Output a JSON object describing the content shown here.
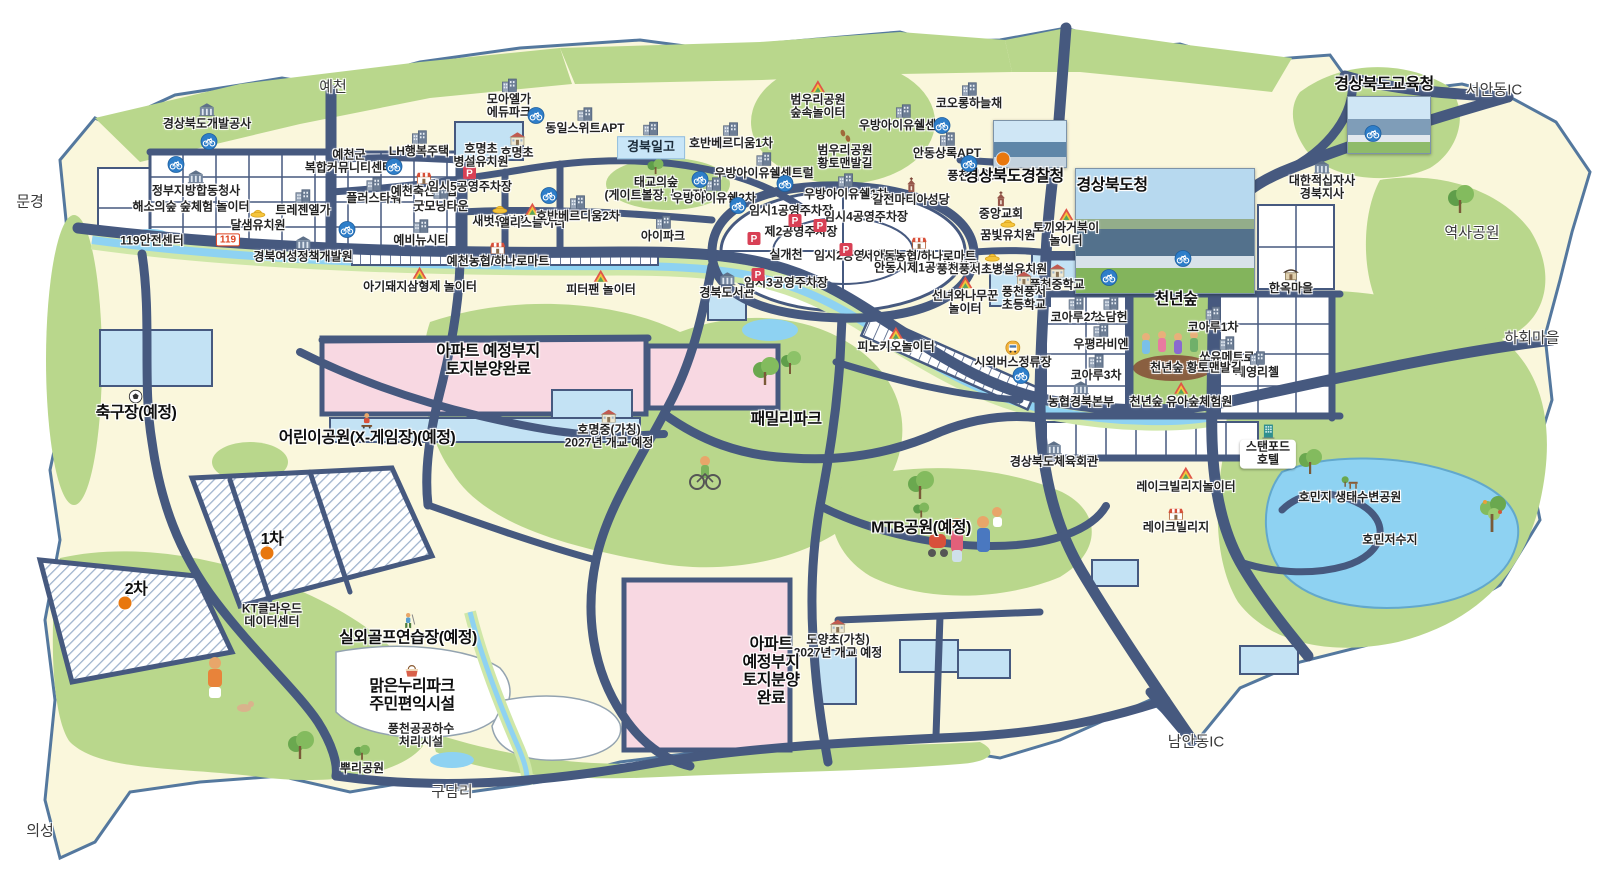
{
  "map": {
    "colors": {
      "road": "#46597f",
      "land": "#faf7dc",
      "park": "#b9d78c",
      "water": "#8ed2f2",
      "river_bank": "#cfe7a8",
      "plot_pink": "#f8d8e2",
      "plot_blue": "#c3e2f4",
      "white_block": "#ffffff",
      "hatch_line": "#9fb3cd",
      "marker_orange": "#e8770e",
      "bike_badge": "#2e7ec9",
      "parking_badge": "#d84055"
    },
    "photos": [
      {
        "name": "gyeongsangbukdo-police-agency-photo",
        "label": "경상북도경찰청"
      },
      {
        "name": "gyeongsangbukdo-provincial-office-photo",
        "label": "경상북도청"
      },
      {
        "name": "gyeongsangbukdo-office-of-education-photo",
        "label": "경상북도교육청"
      }
    ],
    "labels": [
      {
        "t": "예천",
        "x": 333,
        "y": 88,
        "k": "region"
      },
      {
        "t": "문경",
        "x": 30,
        "y": 203,
        "k": "region"
      },
      {
        "t": "의성",
        "x": 40,
        "y": 832,
        "k": "region"
      },
      {
        "t": "구담리",
        "x": 452,
        "y": 793,
        "k": "region"
      },
      {
        "t": "서안동IC",
        "x": 1494,
        "y": 91,
        "k": "region"
      },
      {
        "t": "하회마을",
        "x": 1532,
        "y": 339,
        "k": "region"
      },
      {
        "t": "남안동IC",
        "x": 1196,
        "y": 743,
        "k": "region"
      },
      {
        "t": "역사공원",
        "x": 1472,
        "y": 234,
        "k": "region"
      },
      {
        "t": "경상북도개발공사",
        "x": 207,
        "y": 117,
        "i": "gov"
      },
      {
        "t": "정부지방합동청사",
        "x": 196,
        "y": 184,
        "i": "gov"
      },
      {
        "t": "해소의숲 숲체험 놀이터",
        "x": 191,
        "y": 207
      },
      {
        "t": "119안전센터",
        "x": 152,
        "y": 241
      },
      {
        "t": "119",
        "x": 228,
        "y": 240,
        "k": "b119"
      },
      {
        "t": "달샘유치원",
        "x": 258,
        "y": 220,
        "i": "hat"
      },
      {
        "t": "트레젠엘가",
        "x": 303,
        "y": 203,
        "i": "building"
      },
      {
        "t": "경북여성정책개발원",
        "x": 303,
        "y": 250,
        "i": "gov"
      },
      {
        "t": "예천군\n복합커뮤니티센터",
        "x": 349,
        "y": 162
      },
      {
        "t": "LH행복주택",
        "x": 419,
        "y": 144,
        "i": "building"
      },
      {
        "t": "플러스타워",
        "x": 374,
        "y": 191,
        "i": "building"
      },
      {
        "t": "예천축산농협",
        "x": 424,
        "y": 185,
        "i": "shop"
      },
      {
        "t": "굿모닝타운",
        "x": 441,
        "y": 199,
        "i": "building"
      },
      {
        "t": "임시5공영주차장",
        "x": 470,
        "y": 180,
        "i": "parking"
      },
      {
        "t": "예비뉴시티",
        "x": 421,
        "y": 233,
        "i": "building"
      },
      {
        "t": "모아엘가\n에듀파크",
        "x": 509,
        "y": 99,
        "i": "building"
      },
      {
        "t": "호명초",
        "x": 517,
        "y": 146,
        "i": "school"
      },
      {
        "t": "호명초\n병설유치원",
        "x": 481,
        "y": 156
      },
      {
        "t": "새벗유치원",
        "x": 500,
        "y": 216,
        "i": "hat"
      },
      {
        "t": "앨리스놀이터",
        "x": 532,
        "y": 216,
        "i": "play"
      },
      {
        "t": "동일스위트APT",
        "x": 585,
        "y": 121,
        "i": "building"
      },
      {
        "t": "경북일고",
        "x": 651,
        "y": 140,
        "k": "bluebox",
        "i": "building"
      },
      {
        "t": "태교의숲\n(게이트볼장, 농구장)",
        "x": 656,
        "y": 181,
        "i": "tree"
      },
      {
        "t": "호반베르디움2차",
        "x": 578,
        "y": 209,
        "i": "building"
      },
      {
        "t": "아이파크",
        "x": 663,
        "y": 229,
        "i": "building"
      },
      {
        "t": "예천농협/하나로마트",
        "x": 498,
        "y": 255,
        "i": "shop"
      },
      {
        "t": "아기돼지삼형제 놀이터",
        "x": 420,
        "y": 280,
        "i": "play"
      },
      {
        "t": "피터팬 놀이터",
        "x": 601,
        "y": 283,
        "i": "play"
      },
      {
        "t": "호반베르디움1차",
        "x": 731,
        "y": 136,
        "i": "building"
      },
      {
        "t": "범우리공원\n숲속놀이터",
        "x": 818,
        "y": 100,
        "i": "play"
      },
      {
        "t": "우방아이유쉘센텀",
        "x": 903,
        "y": 118,
        "i": "building"
      },
      {
        "t": "코오롱하늘채",
        "x": 969,
        "y": 96,
        "i": "building"
      },
      {
        "t": "범우리공원\n황토맨발길",
        "x": 845,
        "y": 150,
        "i": "foot"
      },
      {
        "t": "우방아이유쉘센트럴",
        "x": 764,
        "y": 166,
        "i": "building"
      },
      {
        "t": "우방아이유쉘1차",
        "x": 846,
        "y": 187,
        "i": "building"
      },
      {
        "t": "우방아이유쉘2차",
        "x": 714,
        "y": 191,
        "i": "building"
      },
      {
        "t": "안동상록APT",
        "x": 947,
        "y": 146,
        "i": "building"
      },
      {
        "t": "풍천파출소",
        "x": 975,
        "y": 176
      },
      {
        "t": "경상북도경찰청",
        "x": 1014,
        "y": 177,
        "k": "major"
      },
      {
        "t": "갈전마티아성당",
        "x": 911,
        "y": 192,
        "i": "church"
      },
      {
        "t": "중앙교회",
        "x": 1001,
        "y": 206,
        "i": "church"
      },
      {
        "t": "임시1공영주차장",
        "x": 791,
        "y": 211
      },
      {
        "t": "제2공영주차장",
        "x": 801,
        "y": 232
      },
      {
        "t": "임시4공영주차장",
        "x": 866,
        "y": 217
      },
      {
        "t": "실개천",
        "x": 786,
        "y": 255
      },
      {
        "t": "임시2공영주차장",
        "x": 856,
        "y": 256
      },
      {
        "t": "서안동농협/하나로마트",
        "x": 919,
        "y": 250,
        "i": "shop"
      },
      {
        "t": "안동시제1공영주차장",
        "x": 927,
        "y": 268
      },
      {
        "t": "경북도서관",
        "x": 727,
        "y": 286,
        "i": "gov"
      },
      {
        "t": "임시3공영주차장",
        "x": 786,
        "y": 283
      },
      {
        "t": "꿈빛유치원",
        "x": 1008,
        "y": 230,
        "i": "hat"
      },
      {
        "t": "토끼와거북이\n놀이터",
        "x": 1066,
        "y": 228,
        "i": "play"
      },
      {
        "t": "풍천풍서초병설유치원",
        "x": 992,
        "y": 264,
        "i": "hat"
      },
      {
        "t": "풍천중학교",
        "x": 1057,
        "y": 278,
        "i": "school"
      },
      {
        "t": "풍천풍서\n초등학교",
        "x": 1024,
        "y": 292,
        "i": "school"
      },
      {
        "t": "선녀와나무꾼\n놀이터",
        "x": 965,
        "y": 296,
        "i": "play"
      },
      {
        "t": "경상북도청",
        "x": 1112,
        "y": 186,
        "k": "major"
      },
      {
        "t": "경상북도교육청",
        "x": 1384,
        "y": 85,
        "k": "major"
      },
      {
        "t": "대한적십자사\n경북지사",
        "x": 1322,
        "y": 181,
        "i": "gov"
      },
      {
        "t": "한옥마을",
        "x": 1291,
        "y": 281,
        "i": "hanok"
      },
      {
        "t": "코아루2차",
        "x": 1076,
        "y": 310,
        "i": "building"
      },
      {
        "t": "소담헌",
        "x": 1111,
        "y": 310,
        "i": "building"
      },
      {
        "t": "천년숲",
        "x": 1176,
        "y": 300,
        "k": "major"
      },
      {
        "t": "코아루1차",
        "x": 1213,
        "y": 320,
        "i": "building"
      },
      {
        "t": "우평라비엔",
        "x": 1101,
        "y": 337,
        "i": "building"
      },
      {
        "t": "쏘유메트로",
        "x": 1227,
        "y": 350,
        "i": "building"
      },
      {
        "t": "코아루3차",
        "x": 1096,
        "y": 368,
        "i": "building"
      },
      {
        "t": "세영리첼",
        "x": 1257,
        "y": 365,
        "i": "building"
      },
      {
        "t": "천년숲 황토맨발길",
        "x": 1196,
        "y": 368
      },
      {
        "t": "시외버스정류장",
        "x": 1013,
        "y": 355,
        "i": "bus"
      },
      {
        "t": "농협경북본부",
        "x": 1081,
        "y": 395,
        "i": "gov"
      },
      {
        "t": "천년숲 유아숲체험원",
        "x": 1181,
        "y": 395,
        "i": "play"
      },
      {
        "t": "경상북도체육회관",
        "x": 1054,
        "y": 455,
        "i": "gov"
      },
      {
        "t": "레이크빌리지놀이터",
        "x": 1186,
        "y": 480,
        "i": "play"
      },
      {
        "t": "레이크빌리지",
        "x": 1176,
        "y": 521,
        "i": "shop"
      },
      {
        "t": "스탠포드\n호텔",
        "x": 1268,
        "y": 446,
        "k": "box",
        "i": "hotel"
      },
      {
        "t": "호민지 생태수변공원",
        "x": 1350,
        "y": 490,
        "i": "bench"
      },
      {
        "t": "호민저수지",
        "x": 1390,
        "y": 540
      },
      {
        "t": "피노키오놀이터",
        "x": 896,
        "y": 340,
        "i": "play"
      },
      {
        "t": "패밀리파크",
        "x": 786,
        "y": 420,
        "k": "major"
      },
      {
        "t": "아파트 예정부지\n토지분양완료",
        "x": 488,
        "y": 361,
        "k": "major"
      },
      {
        "t": "호명중(가칭)\n2027년 개교 예정",
        "x": 609,
        "y": 430,
        "i": "school"
      },
      {
        "t": "어린이공원(X-게임장)(예정)",
        "x": 367,
        "y": 430,
        "k": "major",
        "i": "skate"
      },
      {
        "t": "축구장(예정)",
        "x": 136,
        "y": 406,
        "k": "major",
        "i": "soccer"
      },
      {
        "t": "1차",
        "x": 272,
        "y": 540,
        "k": "major"
      },
      {
        "t": "2차",
        "x": 136,
        "y": 590,
        "k": "major"
      },
      {
        "t": "KT클라우드\n데이터센터",
        "x": 272,
        "y": 616
      },
      {
        "t": "실외골프연습장(예정)",
        "x": 408,
        "y": 630,
        "k": "major",
        "i": "golf"
      },
      {
        "t": "맑은누리파크\n주민편익시설",
        "x": 412,
        "y": 689,
        "k": "major",
        "i": "basket"
      },
      {
        "t": "풍천공공하수\n처리시설",
        "x": 421,
        "y": 736
      },
      {
        "t": "뿌리공원",
        "x": 362,
        "y": 760,
        "i": "tree"
      },
      {
        "t": "MTB공원(예정)",
        "x": 921,
        "y": 520,
        "k": "major",
        "i": "tree"
      },
      {
        "t": "도양초(가칭)\n2027년 개교 예정",
        "x": 838,
        "y": 640,
        "i": "school"
      },
      {
        "t": "아파트\n예정부지\n토지분양\n완료",
        "x": 771,
        "y": 672,
        "k": "major"
      }
    ],
    "bike_icons": [
      [
        209,
        144
      ],
      [
        176,
        167
      ],
      [
        347,
        232
      ],
      [
        394,
        169
      ],
      [
        536,
        118
      ],
      [
        549,
        198
      ],
      [
        785,
        186
      ],
      [
        738,
        208
      ],
      [
        942,
        128
      ],
      [
        969,
        166
      ],
      [
        1183,
        261
      ],
      [
        1109,
        280
      ],
      [
        1373,
        136
      ],
      [
        1021,
        378
      ],
      [
        700,
        182
      ]
    ],
    "parking_icons": [
      [
        795,
        223
      ],
      [
        754,
        241
      ],
      [
        820,
        228
      ],
      [
        846,
        252
      ],
      [
        758,
        277
      ]
    ],
    "marker_dots": [
      [
        1003,
        159
      ],
      [
        267,
        553
      ],
      [
        125,
        603
      ]
    ]
  }
}
